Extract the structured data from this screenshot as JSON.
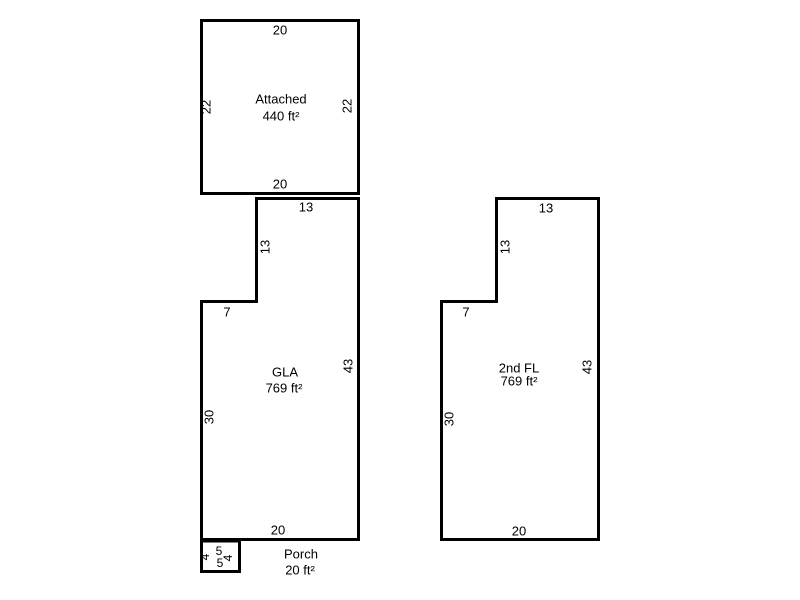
{
  "colors": {
    "wall": "#000000",
    "background": "#ffffff",
    "text": "#000000"
  },
  "areas": {
    "attached": {
      "label": "Attached",
      "area": "440 ft²",
      "dims": {
        "top": "20",
        "left": "22",
        "right": "22",
        "bottom": "20"
      }
    },
    "gla": {
      "label": "GLA",
      "area": "769 ft²",
      "dims": {
        "top": "13",
        "upper_left": "13",
        "step": "7",
        "lower_left": "30",
        "right": "43",
        "bottom": "20"
      }
    },
    "second_floor": {
      "label": "2nd FL",
      "area": "769 ft²",
      "dims": {
        "top": "13",
        "upper_left": "13",
        "step": "7",
        "lower_left": "30",
        "right": "43",
        "bottom": "20"
      }
    },
    "porch": {
      "label": "Porch",
      "area": "20 ft²",
      "dims": {
        "left": "4",
        "top": "5",
        "right": "4",
        "bottom": "5"
      }
    }
  }
}
